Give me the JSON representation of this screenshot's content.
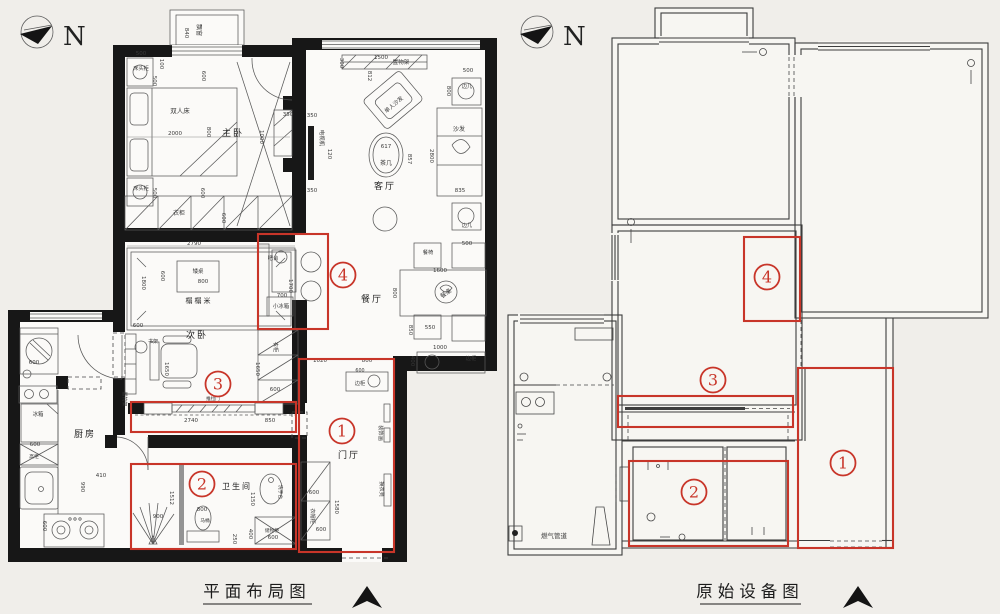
{
  "page": {
    "background": "#f0eeea"
  },
  "colors": {
    "annotation_red": "#c83529",
    "wall_black": "#171717",
    "line_gray": "#585858"
  },
  "compass": {
    "letter": "N"
  },
  "footer": {
    "left_title": "平面布局图",
    "right_title": "原始设备图"
  },
  "annotations": {
    "left": {
      "circles": [
        {
          "n": "1",
          "x": 342,
          "y": 431
        },
        {
          "n": "2",
          "x": 202,
          "y": 484
        },
        {
          "n": "3",
          "x": 218,
          "y": 384
        },
        {
          "n": "4",
          "x": 343,
          "y": 275
        }
      ],
      "rects": [
        {
          "zone": "1",
          "x": 299,
          "y": 359,
          "w": 95,
          "h": 193
        },
        {
          "zone": "2",
          "x": 131,
          "y": 464,
          "w": 165,
          "h": 85
        },
        {
          "zone": "3",
          "x": 131,
          "y": 402,
          "w": 165,
          "h": 30
        },
        {
          "zone": "4",
          "x": 258,
          "y": 234,
          "w": 70,
          "h": 95
        }
      ]
    },
    "right": {
      "circles": [
        {
          "n": "1",
          "x": 843,
          "y": 463
        },
        {
          "n": "2",
          "x": 694,
          "y": 492
        },
        {
          "n": "3",
          "x": 713,
          "y": 380
        },
        {
          "n": "4",
          "x": 767,
          "y": 277
        }
      ],
      "rects": [
        {
          "zone": "1",
          "x": 798,
          "y": 368,
          "w": 95,
          "h": 180
        },
        {
          "zone": "2",
          "x": 629,
          "y": 461,
          "w": 159,
          "h": 85
        },
        {
          "zone": "3",
          "x": 618,
          "y": 396,
          "w": 175,
          "h": 31
        },
        {
          "zone": "4",
          "x": 744,
          "y": 237,
          "w": 56,
          "h": 84
        }
      ]
    }
  },
  "left_plan": {
    "labels": [
      {
        "t": "主卧",
        "x": 233,
        "y": 136,
        "s": 9,
        "c": "room"
      },
      {
        "t": "客厅",
        "x": 385,
        "y": 189,
        "s": 9,
        "c": "room"
      },
      {
        "t": "餐厅",
        "x": 372,
        "y": 302,
        "s": 9,
        "c": "room"
      },
      {
        "t": "次卧",
        "x": 197,
        "y": 338,
        "s": 9,
        "c": "room"
      },
      {
        "t": "榻榻米",
        "x": 199,
        "y": 303,
        "s": 7,
        "c": "room"
      },
      {
        "t": "厨房",
        "x": 85,
        "y": 437,
        "s": 9,
        "c": "room"
      },
      {
        "t": "卫生间",
        "x": 237,
        "y": 489,
        "s": 8,
        "c": "room"
      },
      {
        "t": "门厅",
        "x": 349,
        "y": 458,
        "s": 9,
        "c": "room"
      },
      {
        "t": "飘窗",
        "x": 197,
        "y": 30,
        "r": 90,
        "s": 6
      },
      {
        "t": "双人床",
        "x": 180,
        "y": 113,
        "s": 6.5
      },
      {
        "t": "床头柜",
        "x": 141,
        "y": 70,
        "s": 5.2
      },
      {
        "t": "床头柜",
        "x": 141,
        "y": 190,
        "s": 5.2
      },
      {
        "t": "衣柜",
        "x": 179,
        "y": 215,
        "s": 6
      },
      {
        "t": "置物架",
        "x": 401,
        "y": 64,
        "s": 5.6
      },
      {
        "t": "单人沙发",
        "x": 395,
        "y": 106,
        "r": -40,
        "s": 5.6
      },
      {
        "t": "电视机",
        "x": 320,
        "y": 138,
        "r": 90,
        "s": 5.4
      },
      {
        "t": "茶几",
        "x": 386,
        "y": 165,
        "s": 6
      },
      {
        "t": "沙发",
        "x": 459,
        "y": 131,
        "s": 6
      },
      {
        "t": "边几",
        "x": 467,
        "y": 88,
        "s": 5.2
      },
      {
        "t": "边几",
        "x": 467,
        "y": 227,
        "s": 5.2
      },
      {
        "t": "餐椅",
        "x": 428,
        "y": 254,
        "s": 5.2
      },
      {
        "t": "餐桌",
        "x": 447,
        "y": 295,
        "r": -36,
        "s": 6
      },
      {
        "t": "边柜",
        "x": 471,
        "y": 360,
        "s": 5.2
      },
      {
        "t": "边柜",
        "x": 360,
        "y": 385,
        "s": 5.2
      },
      {
        "t": "装饰画",
        "x": 379,
        "y": 433,
        "r": 90,
        "s": 5.2
      },
      {
        "t": "换衣凳",
        "x": 380,
        "y": 489,
        "r": 90,
        "s": 5.2
      },
      {
        "t": "衣帽柜",
        "x": 311,
        "y": 516,
        "r": 90,
        "s": 5.2
      },
      {
        "t": "书架",
        "x": 153,
        "y": 343,
        "s": 5
      },
      {
        "t": "置物架",
        "x": 123,
        "y": 399,
        "r": 90,
        "s": 5
      },
      {
        "t": "衣柜",
        "x": 274,
        "y": 347,
        "r": 90,
        "s": 5.2
      },
      {
        "t": "小冰箱",
        "x": 281,
        "y": 308,
        "s": 5.4
      },
      {
        "t": "吧台",
        "x": 273,
        "y": 260,
        "s": 5.4
      },
      {
        "t": "推拉门",
        "x": 213,
        "y": 400,
        "s": 4.6
      },
      {
        "t": "马桶",
        "x": 205,
        "y": 522,
        "s": 4.8
      },
      {
        "t": "洗手台",
        "x": 279,
        "y": 492,
        "r": 90,
        "s": 4.8
      },
      {
        "t": "储物柜",
        "x": 272,
        "y": 532,
        "s": 4.8
      },
      {
        "t": "冰箱",
        "x": 38,
        "y": 416,
        "s": 5.4
      },
      {
        "t": "高柜",
        "x": 34,
        "y": 458,
        "s": 4.8
      },
      {
        "t": "矮桌",
        "x": 198,
        "y": 273,
        "s": 5.4
      },
      {
        "t": "840",
        "x": 185,
        "y": 33,
        "r": 90
      },
      {
        "t": "500",
        "x": 141,
        "y": 55
      },
      {
        "t": "100",
        "x": 160,
        "y": 64,
        "r": 90
      },
      {
        "t": "500",
        "x": 153,
        "y": 81,
        "r": 90
      },
      {
        "t": "600",
        "x": 202,
        "y": 76,
        "r": 90
      },
      {
        "t": "2000",
        "x": 175,
        "y": 135
      },
      {
        "t": "800",
        "x": 207,
        "y": 132,
        "r": 90
      },
      {
        "t": "1000",
        "x": 260,
        "y": 137,
        "r": 90
      },
      {
        "t": "350",
        "x": 288,
        "y": 116
      },
      {
        "t": "500",
        "x": 153,
        "y": 193,
        "r": 90
      },
      {
        "t": "600",
        "x": 201,
        "y": 193,
        "r": 90
      },
      {
        "t": "600",
        "x": 222,
        "y": 218,
        "r": 90
      },
      {
        "t": "300",
        "x": 340,
        "y": 63,
        "r": 90
      },
      {
        "t": "1500",
        "x": 381,
        "y": 59
      },
      {
        "t": "812",
        "x": 368,
        "y": 76,
        "r": 90
      },
      {
        "t": "500",
        "x": 468,
        "y": 72
      },
      {
        "t": "800",
        "x": 447,
        "y": 91,
        "r": 90
      },
      {
        "t": "350",
        "x": 312,
        "y": 117
      },
      {
        "t": "120",
        "x": 328,
        "y": 154,
        "r": 90
      },
      {
        "t": "350",
        "x": 312,
        "y": 192
      },
      {
        "t": "617",
        "x": 386,
        "y": 148
      },
      {
        "t": "857",
        "x": 408,
        "y": 159,
        "r": 90
      },
      {
        "t": "2800",
        "x": 430,
        "y": 156,
        "r": 90
      },
      {
        "t": "835",
        "x": 460,
        "y": 192
      },
      {
        "t": "500",
        "x": 467,
        "y": 245
      },
      {
        "t": "1600",
        "x": 440,
        "y": 272
      },
      {
        "t": "800",
        "x": 393,
        "y": 293,
        "r": 90
      },
      {
        "t": "550",
        "x": 430,
        "y": 329
      },
      {
        "t": "850",
        "x": 409,
        "y": 330,
        "r": 90
      },
      {
        "t": "1000",
        "x": 440,
        "y": 349
      },
      {
        "t": "400",
        "x": 411,
        "y": 361,
        "r": 90
      },
      {
        "t": "1700",
        "x": 289,
        "y": 286,
        "r": 90
      },
      {
        "t": "700",
        "x": 282,
        "y": 297
      },
      {
        "t": "2790",
        "x": 194,
        "y": 245
      },
      {
        "t": "1800",
        "x": 142,
        "y": 283,
        "r": 90
      },
      {
        "t": "600",
        "x": 161,
        "y": 276,
        "r": 90
      },
      {
        "t": "800",
        "x": 203,
        "y": 283
      },
      {
        "t": "600",
        "x": 138,
        "y": 327
      },
      {
        "t": "1650",
        "x": 165,
        "y": 369,
        "r": 90
      },
      {
        "t": "1650",
        "x": 256,
        "y": 369,
        "r": 90
      },
      {
        "t": "600",
        "x": 275,
        "y": 391
      },
      {
        "t": "2740",
        "x": 191,
        "y": 422
      },
      {
        "t": "850",
        "x": 270,
        "y": 422
      },
      {
        "t": "900",
        "x": 158,
        "y": 518
      },
      {
        "t": "1512",
        "x": 170,
        "y": 498,
        "r": 90
      },
      {
        "t": "800",
        "x": 202,
        "y": 511
      },
      {
        "t": "1150",
        "x": 251,
        "y": 499,
        "r": 90
      },
      {
        "t": "400",
        "x": 249,
        "y": 534,
        "r": 90
      },
      {
        "t": "250",
        "x": 233,
        "y": 539,
        "r": 90
      },
      {
        "t": "600",
        "x": 273,
        "y": 539
      },
      {
        "t": "600",
        "x": 34,
        "y": 364
      },
      {
        "t": "600",
        "x": 35,
        "y": 446
      },
      {
        "t": "990",
        "x": 81,
        "y": 487,
        "r": 90
      },
      {
        "t": "410",
        "x": 101,
        "y": 477
      },
      {
        "t": "600",
        "x": 43,
        "y": 526,
        "r": 90
      },
      {
        "t": "1020",
        "x": 320,
        "y": 362
      },
      {
        "t": "800",
        "x": 367,
        "y": 362
      },
      {
        "t": "600",
        "x": 360,
        "y": 372,
        "s": 4.8
      },
      {
        "t": "600",
        "x": 314,
        "y": 494
      },
      {
        "t": "1580",
        "x": 335,
        "y": 507,
        "r": 90
      },
      {
        "t": "600",
        "x": 321,
        "y": 531
      }
    ]
  },
  "right_plan": {
    "labels": [
      {
        "t": "燃气管道",
        "x": 554,
        "y": 538,
        "s": 6.5
      }
    ]
  }
}
